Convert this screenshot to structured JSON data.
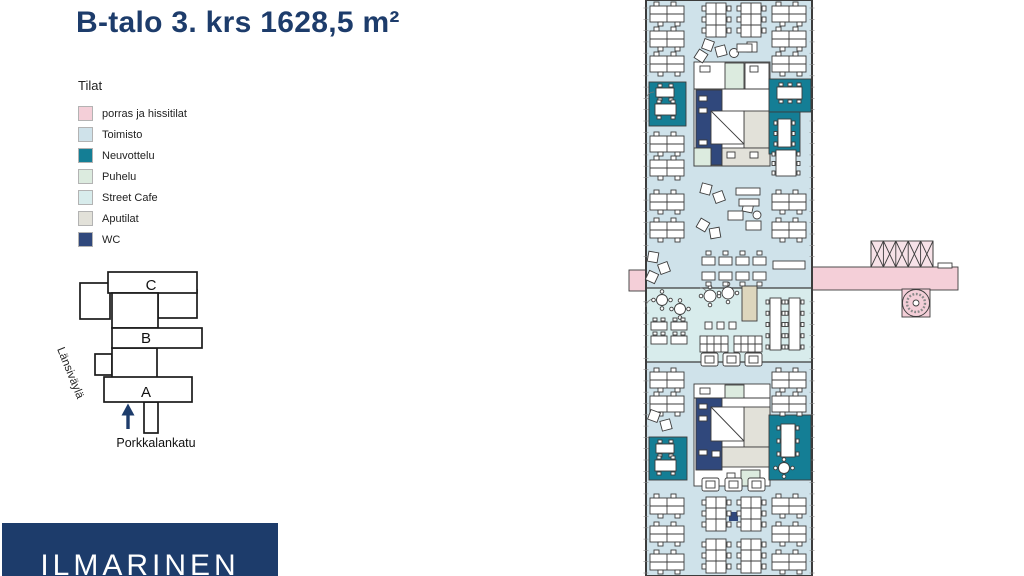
{
  "page": {
    "title": "B-talo 3. krs 1628,5 m²"
  },
  "legend": {
    "title": "Tilat",
    "items": [
      {
        "key": "porras",
        "label": "porras ja hissitilat",
        "color": "#f4cfd8"
      },
      {
        "key": "toimisto",
        "label": "Toimisto",
        "color": "#cfe2ea"
      },
      {
        "key": "neuvottelu",
        "label": "Neuvottelu",
        "color": "#147e95"
      },
      {
        "key": "puhelu",
        "label": "Puhelu",
        "color": "#dcebdf"
      },
      {
        "key": "streetcafe",
        "label": "Street Cafe",
        "color": "#d8ecec"
      },
      {
        "key": "aputilat",
        "label": "Aputilat",
        "color": "#e2e1d9"
      },
      {
        "key": "wc",
        "label": "WC",
        "color": "#30487c"
      }
    ]
  },
  "site_map": {
    "building_labels": [
      "C",
      "B",
      "A"
    ],
    "highlighted_building": "B",
    "street_left": "Länsiväylä",
    "street_bottom": "Porkkalankatu"
  },
  "logo": {
    "text": "ILMARINEN"
  },
  "colors": {
    "accent": "#1d3c6b",
    "wall": "#3c3c3c",
    "counter": "#ddd6bd",
    "pinklight": "#f7e2e8"
  }
}
